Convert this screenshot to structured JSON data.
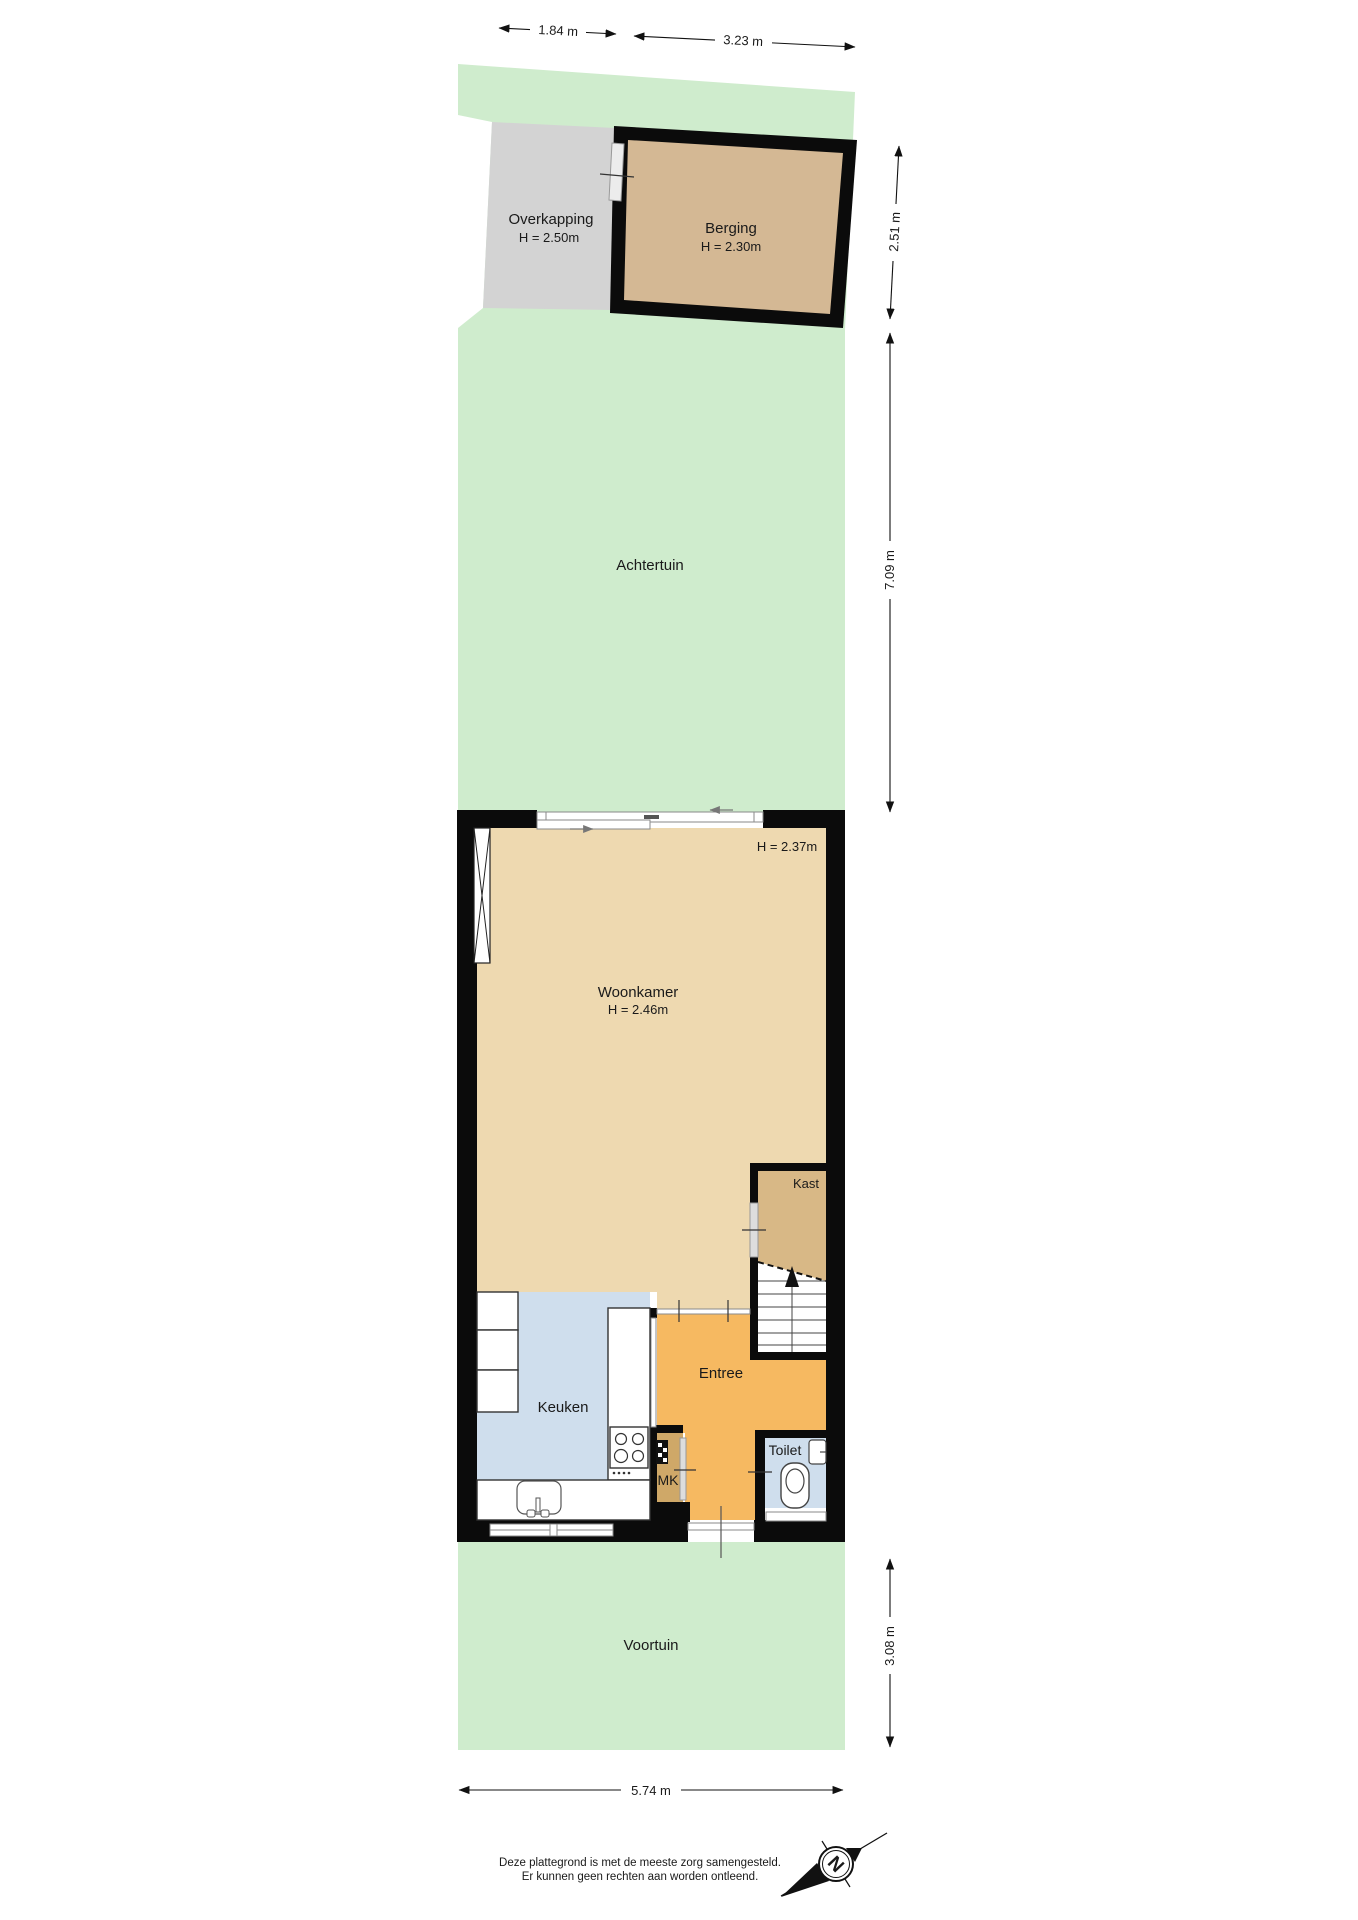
{
  "plan": {
    "rooms": {
      "overkapping": {
        "name": "Overkapping",
        "height": "H = 2.50m"
      },
      "berging": {
        "name": "Berging",
        "height": "H = 2.30m"
      },
      "achtertuin": {
        "name": "Achtertuin"
      },
      "woonkamer": {
        "name": "Woonkamer",
        "height": "H = 2.46m",
        "height2": "H = 2.37m"
      },
      "kast": {
        "name": "Kast"
      },
      "keuken": {
        "name": "Keuken"
      },
      "entree": {
        "name": "Entree"
      },
      "mk": {
        "name": "MK"
      },
      "toilet": {
        "name": "Toilet"
      },
      "voortuin": {
        "name": "Voortuin"
      }
    },
    "dimensions": {
      "top_left": "1.84 m",
      "top_right": "3.23 m",
      "right_upper": "2.51 m",
      "right_middle": "7.09 m",
      "right_lower": "3.08 m",
      "bottom": "5.74 m"
    },
    "compass": {
      "north_label": "N"
    },
    "footer": {
      "line1": "Deze plattegrond is met de meeste zorg samengesteld.",
      "line2": "Er kunnen geen rechten aan worden ontleend."
    },
    "colors": {
      "garden_green": "#cfeccd",
      "woonkamer_floor": "#eed9b0",
      "kast_floor": "#d8b886",
      "berging_floor": "#d4b894",
      "overkapping_floor": "#d3d3d3",
      "keuken_floor": "#cfdeed",
      "toilet_floor": "#cfdeed",
      "entree_floor": "#f6b961",
      "mk_floor": "#cfa868",
      "wall": "#0b0b0b"
    }
  }
}
